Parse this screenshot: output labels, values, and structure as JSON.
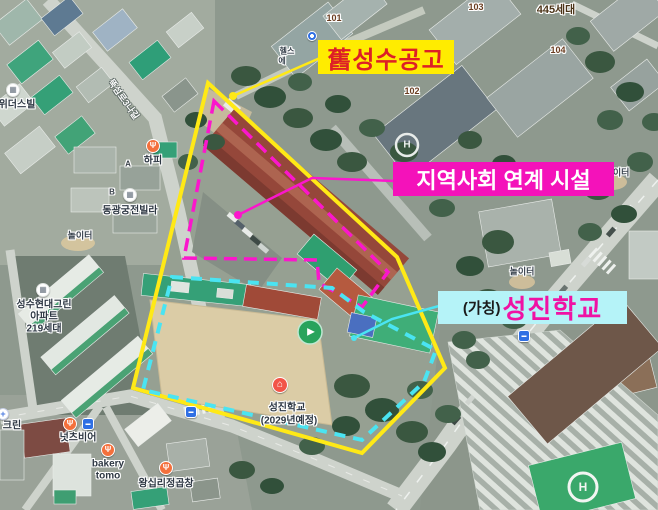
{
  "callouts": {
    "old_factory": {
      "text": "舊성수공고",
      "bg": "#ffec00",
      "color": "#dd2026"
    },
    "community": {
      "text": "지역사회 연계 시설",
      "bg": "#f412ba",
      "color": "#ffffff"
    },
    "school": {
      "prefix": "(가칭)",
      "name": "성진학교",
      "bg": "#b5f3f8",
      "prefix_color": "#1b1b1b",
      "name_color": "#ef12a4"
    }
  },
  "overlays": {
    "site": {
      "points": "208,83 397,257 445,368 362,453 133,388",
      "color": "#ffe916",
      "width": 4
    },
    "facility": {
      "points": "214,101 388,272 362,307 319,283 317,260 184,258",
      "color": "#fb16cc",
      "width": 3.5,
      "dash": "13 7"
    },
    "school_area": {
      "points": "172,277 332,288 364,312 436,350 424,382 362,440 143,390",
      "color": "#4ae4f2",
      "width": 4,
      "dash": "11 8"
    },
    "leaders": [
      {
        "path": "M320,58 L233,96",
        "color": "#ffe916",
        "dot": {
          "x": 233,
          "y": 96,
          "r": 4
        }
      },
      {
        "path": "M394,181 L312,178 L238,215",
        "color": "#fb16cc",
        "dot": {
          "x": 238,
          "y": 215,
          "r": 4
        }
      },
      {
        "path": "M439,306 L392,319 L354,338",
        "color": "#4ae4f2",
        "dot": {
          "x": 354,
          "y": 338,
          "r": 3
        }
      }
    ]
  },
  "imagery": {
    "helipad_letter": "H",
    "panorama_glyph": "▶"
  },
  "icon_glyphs": {
    "food": "Ψ",
    "building": "▦",
    "school": "⌂",
    "bus": "▬",
    "metro": "",
    "shop": "+"
  },
  "icons": [
    {
      "type": "metro",
      "x": 312,
      "y": 36,
      "name": "subway-icon"
    },
    {
      "type": "food",
      "x": 153,
      "y": 146,
      "name": "hapi-food-icon"
    },
    {
      "type": "building",
      "x": 130,
      "y": 195,
      "name": "dongkwang-building-icon"
    },
    {
      "type": "building",
      "x": 13,
      "y": 90,
      "name": "widersville-building-icon"
    },
    {
      "type": "building",
      "x": 43,
      "y": 290,
      "name": "hyundai-green-building-icon"
    },
    {
      "type": "food",
      "x": 70,
      "y": 424,
      "name": "nutsbeer-food-icon"
    },
    {
      "type": "bus",
      "x": 88,
      "y": 424,
      "name": "nutsbeer-busstop-icon"
    },
    {
      "type": "shop",
      "x": 3,
      "y": 414,
      "name": "clean-shop-icon"
    },
    {
      "type": "food",
      "x": 108,
      "y": 450,
      "name": "bakery-food-icon"
    },
    {
      "type": "food",
      "x": 166,
      "y": 468,
      "name": "wangsimni-food-icon"
    },
    {
      "type": "school",
      "x": 280,
      "y": 385,
      "name": "school-marker-icon"
    },
    {
      "type": "bus",
      "x": 191,
      "y": 412,
      "name": "south-busstop-icon"
    },
    {
      "type": "bus",
      "x": 524,
      "y": 336,
      "name": "east-busstop-icon"
    }
  ],
  "map_labels": [
    {
      "text": "101",
      "x": 334,
      "y": 18,
      "cls": "num",
      "name": "building-101-label"
    },
    {
      "text": "103",
      "x": 476,
      "y": 7,
      "cls": "num",
      "name": "building-103-label"
    },
    {
      "text": "445세대",
      "x": 556,
      "y": 9,
      "cls": "numbold",
      "name": "complex-units-label"
    },
    {
      "text": "104",
      "x": 558,
      "y": 50,
      "cls": "num",
      "name": "building-104-label"
    },
    {
      "text": "102",
      "x": 412,
      "y": 91,
      "cls": "num",
      "name": "building-102-label"
    },
    {
      "text": "헬스",
      "x": 287,
      "y": 51,
      "cls": "tiny",
      "name": "gym-label-line1"
    },
    {
      "text": "에",
      "x": 282,
      "y": 61,
      "cls": "tiny",
      "name": "gym-label-line2"
    },
    {
      "text": "위더스빌",
      "x": 17,
      "y": 103,
      "cls": "poi",
      "name": "widersville-label"
    },
    {
      "text": "뚝섬로3나길",
      "x": 124,
      "y": 99,
      "cls": "road",
      "rotate": 55,
      "name": "street-name-label"
    },
    {
      "text": "하피",
      "x": 153,
      "y": 159,
      "cls": "poi",
      "name": "hapi-label"
    },
    {
      "text": "A",
      "x": 128,
      "y": 164,
      "cls": "roof",
      "name": "roof-letter-a"
    },
    {
      "text": "B",
      "x": 112,
      "y": 192,
      "cls": "roof",
      "name": "roof-letter-b"
    },
    {
      "text": "동광궁전빌라",
      "x": 130,
      "y": 209,
      "cls": "poi",
      "name": "dongkwang-villa-label"
    },
    {
      "text": "놀이터",
      "x": 80,
      "y": 235,
      "cls": "small",
      "name": "playground-label-west"
    },
    {
      "text": "놀이터",
      "x": 617,
      "y": 172,
      "cls": "small",
      "name": "playground-label-northeast"
    },
    {
      "text": "놀이터",
      "x": 522,
      "y": 271,
      "cls": "small",
      "name": "playground-label-east"
    },
    {
      "text": "성수현대그린",
      "x": 44,
      "y": 303,
      "cls": "poi",
      "name": "hyundai-green-apt-label-line1"
    },
    {
      "text": "아파트",
      "x": 44,
      "y": 315,
      "cls": "poi",
      "name": "hyundai-green-apt-label-line2"
    },
    {
      "text": "219세대",
      "x": 44,
      "y": 327,
      "cls": "poi",
      "name": "hyundai-green-apt-label-line3"
    },
    {
      "text": "성진학교",
      "x": 287,
      "y": 406,
      "cls": "poi",
      "name": "seongjin-school-map-label-line1"
    },
    {
      "text": "(2029년예정)",
      "x": 289,
      "y": 419,
      "cls": "poi",
      "name": "seongjin-school-map-label-line2"
    },
    {
      "text": "넛츠비어",
      "x": 78,
      "y": 436,
      "cls": "poi",
      "name": "nutsbeer-label"
    },
    {
      "text": "bakery",
      "x": 108,
      "y": 464,
      "cls": "poi",
      "name": "bakery-tomo-label-line1"
    },
    {
      "text": "tomo",
      "x": 108,
      "y": 476,
      "cls": "poi",
      "name": "bakery-tomo-label-line2"
    },
    {
      "text": "왕십리정곱창",
      "x": 166,
      "y": 482,
      "cls": "poi",
      "name": "wangsimni-gopchang-label"
    },
    {
      "text": "크린",
      "x": 12,
      "y": 424,
      "cls": "poi",
      "name": "clean-shop-label"
    }
  ]
}
